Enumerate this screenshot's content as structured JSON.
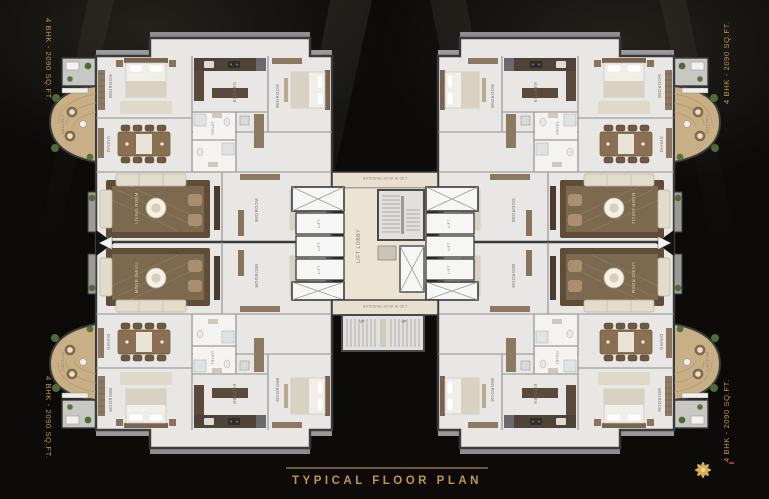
{
  "colors": {
    "gold": "#c49344",
    "background": "#0c0b0a",
    "floor": "#e8e7e5",
    "wood_deck": "#c9af85",
    "wall": "#3a3a3c"
  },
  "corner_labels": {
    "top_left": "4 BHK - 2090 SQ.FT.",
    "top_right": "4 BHK - 2090 SQ.FT.",
    "bottom_left": "4 BHK - 2090 SQ.FT.",
    "bottom_right": "4 BHK - 2090 SQ.FT."
  },
  "footer": {
    "title": "TYPICAL FLOOR PLAN"
  },
  "plan": {
    "core": {
      "lift": "LIFT",
      "lift_lobby": "LIFT LOBBY",
      "passage": "1.50 M WIDE PASSAGE",
      "up": "UP"
    },
    "rooms": {
      "bedroom": "BEDROOM",
      "living": "LIVING ROOM",
      "dining": "DINING",
      "kitchen": "KITCHEN",
      "toilet": "TOILET",
      "balcony": "BALCONY"
    }
  }
}
